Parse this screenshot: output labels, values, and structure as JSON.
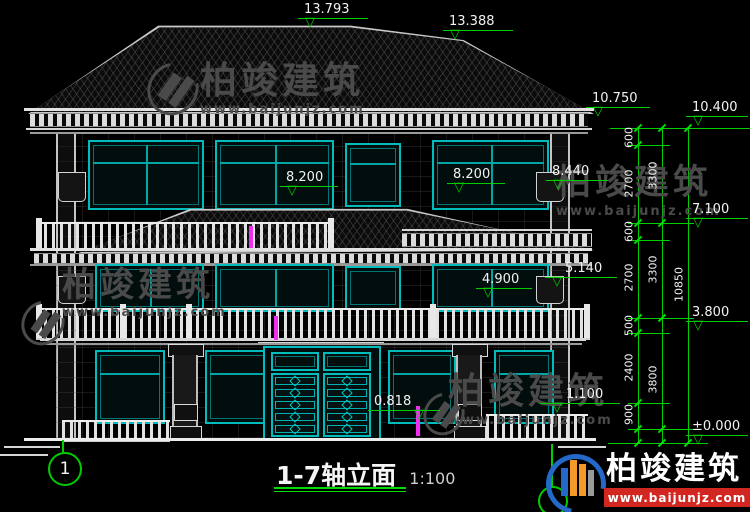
{
  "title": {
    "name": "1-7轴立面",
    "scale": "1:100"
  },
  "axis": {
    "left_bubble": "1"
  },
  "levels": {
    "ridge_main": "13.793",
    "ridge_secondary": "13.388",
    "eave_high": "10.750",
    "eave_low": "10.400",
    "mid_roof_right": "8.440",
    "floor3_balcony_left": "8.200",
    "floor3_balcony_right": "8.200",
    "mid_roof_eave": "7.100",
    "floor2_rail_right": "5.140",
    "floor2_rail_left": "4.900",
    "floor2_slab": "3.800",
    "porch_right": "1.100",
    "porch_left": "0.818",
    "ground": "±0.000"
  },
  "dimensions": {
    "segments_inner": [
      "600",
      "2700",
      "600",
      "2700",
      "500",
      "2400",
      "900"
    ],
    "segments_floor": [
      "3300",
      "3300",
      "3800"
    ],
    "overall": "10850"
  },
  "watermark": {
    "brand": "柏竣建筑",
    "url": "www.baijunjz.com"
  },
  "logo": {
    "brand": "柏竣建筑",
    "url": "www.baijunjz.com"
  },
  "colors": {
    "annotation_green": "#00cf00",
    "window_cyan": "#00bcbc",
    "line_white": "#d6d6d6",
    "magenta": "#f02df0",
    "logo_red": "#d22620",
    "logo_blue": "#2468c8",
    "logo_orange": "#f59a28",
    "watermark_gray": "#4a4a4a"
  }
}
